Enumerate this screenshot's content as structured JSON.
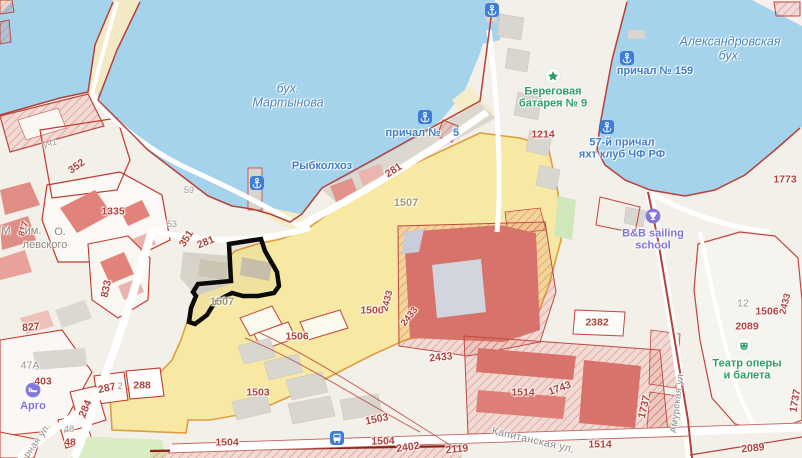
{
  "map": {
    "colors": {
      "water": "#a6d3ec",
      "highlight_parcel": "#f7e9a4",
      "selected_outline": "#0a0a0a",
      "boundary_red": "#b5413a",
      "poi_blue": "#3f7ec6",
      "poi_green": "#2f9e63",
      "poi_purple": "#7f72d8"
    },
    "bay_labels": [
      {
        "name": "martynova-bay-label",
        "lines": [
          "бух.",
          "Мартынова"
        ],
        "x": 288,
        "y": 96
      },
      {
        "name": "alexandrovskaya-bay-label",
        "lines": [
          "Александровская",
          "бух."
        ],
        "x": 730,
        "y": 49
      }
    ],
    "street_labels": [
      {
        "name": "kapitanskaya-street-label",
        "text": "Капитанская ул.",
        "x": 533,
        "y": 441,
        "rotate": 13,
        "size": 10.5
      },
      {
        "name": "amurskaya-street-label",
        "text": "Амурская ул.",
        "x": 678,
        "y": 402,
        "rotate": -83,
        "size": 9.5
      },
      {
        "name": "ernaya-street-label",
        "text": "рная ул.",
        "x": 38,
        "y": 441,
        "rotate": -55,
        "size": 9.5
      }
    ],
    "poi_labels": [
      {
        "name": "prichal-159-label",
        "lines": [
          "причал № 159"
        ],
        "x": 655,
        "y": 71,
        "color": "blue"
      },
      {
        "name": "prichal-label-fragment",
        "lines": [
          "причал №"
        ],
        "x": 413,
        "y": 133,
        "color": "blue"
      },
      {
        "name": "prichal-number-fragment",
        "lines": [
          "5"
        ],
        "x": 456,
        "y": 133,
        "color": "blue"
      },
      {
        "name": "rybkolkhoz-label",
        "lines": [
          "Рыбколхоз"
        ],
        "x": 322,
        "y": 166,
        "color": "blue"
      },
      {
        "name": "beregovaya-batareya-label",
        "lines": [
          "Береговая",
          "батарея № 9"
        ],
        "x": 553,
        "y": 98,
        "color": "green"
      },
      {
        "name": "prichal-57-yacht-club-label",
        "lines": [
          "57-й причал",
          "яхт клуб ЧФ РФ"
        ],
        "x": 622,
        "y": 149,
        "color": "blue"
      },
      {
        "name": "bb-sailing-school-label",
        "lines": [
          "B&B sailing",
          "school"
        ],
        "x": 653,
        "y": 240,
        "color": "purple"
      },
      {
        "name": "opera-ballet-theatre-label",
        "lines": [
          "Театр оперы",
          "и балета"
        ],
        "x": 747,
        "y": 370,
        "color": "green"
      },
      {
        "name": "argo-label",
        "lines": [
          "Арго"
        ],
        "x": 33,
        "y": 406,
        "color": "purple"
      }
    ],
    "icons": [
      {
        "name": "anchor-icon",
        "type": "anchor",
        "x": 492,
        "y": 10
      },
      {
        "name": "anchor-icon",
        "type": "anchor",
        "x": 257,
        "y": 183
      },
      {
        "name": "anchor-icon",
        "type": "anchor",
        "x": 425,
        "y": 117
      },
      {
        "name": "anchor-icon",
        "type": "anchor",
        "x": 627,
        "y": 58
      },
      {
        "name": "anchor-icon",
        "type": "anchor",
        "x": 607,
        "y": 127
      },
      {
        "name": "bus-stop-icon",
        "type": "bus",
        "x": 337,
        "y": 438
      },
      {
        "name": "battery-star-icon",
        "type": "star",
        "x": 553,
        "y": 76
      },
      {
        "name": "sailing-school-trophy-icon",
        "type": "trophy",
        "x": 653,
        "y": 216
      },
      {
        "name": "theatre-mask-icon",
        "type": "theater",
        "x": 744,
        "y": 346
      },
      {
        "name": "argo-hotel-icon",
        "type": "hotel",
        "x": 33,
        "y": 390
      }
    ],
    "cadastral_numbers": [
      {
        "t": "уч1",
        "x": 50,
        "y": 144,
        "c": "grey",
        "r": -15,
        "s": 9
      },
      {
        "t": "352",
        "x": 77,
        "y": 167,
        "c": "red",
        "r": -35
      },
      {
        "t": "1335",
        "x": 113,
        "y": 212,
        "c": "red"
      },
      {
        "t": "817",
        "x": 24,
        "y": 229,
        "c": "red",
        "r": -72,
        "s": 9
      },
      {
        "t": "М",
        "x": 6,
        "y": 232,
        "c": "brown",
        "s": 11
      },
      {
        "t": "им.",
        "x": 33,
        "y": 232,
        "c": "brown",
        "s": 11
      },
      {
        "t": "О.",
        "x": 60,
        "y": 233,
        "c": "brown",
        "s": 11
      },
      {
        "t": "левского",
        "x": 45,
        "y": 246,
        "c": "brown",
        "s": 11
      },
      {
        "t": "59",
        "x": 189,
        "y": 191,
        "c": "grey",
        "s": 9
      },
      {
        "t": "53",
        "x": 172,
        "y": 225,
        "c": "grey",
        "s": 9
      },
      {
        "t": "351",
        "x": 187,
        "y": 239,
        "c": "red",
        "r": -58
      },
      {
        "t": "281",
        "x": 206,
        "y": 243,
        "c": "red",
        "r": -22
      },
      {
        "t": "281",
        "x": 394,
        "y": 171,
        "c": "red",
        "r": -33
      },
      {
        "t": "1507",
        "x": 222,
        "y": 303,
        "c": "olive",
        "s": 11
      },
      {
        "t": "1507",
        "x": 406,
        "y": 204,
        "c": "olive",
        "s": 11
      },
      {
        "t": "833",
        "x": 107,
        "y": 289,
        "c": "red",
        "r": -78
      },
      {
        "t": "827",
        "x": 31,
        "y": 328,
        "c": "red",
        "r": -6
      },
      {
        "t": "47A",
        "x": 30,
        "y": 366,
        "c": "grey"
      },
      {
        "t": "403",
        "x": 43,
        "y": 382,
        "c": "red"
      },
      {
        "t": "287",
        "x": 107,
        "y": 389,
        "c": "red",
        "r": -12
      },
      {
        "t": "2",
        "x": 120,
        "y": 387,
        "c": "grey",
        "s": 9
      },
      {
        "t": "288",
        "x": 142,
        "y": 386,
        "c": "red"
      },
      {
        "t": "284",
        "x": 86,
        "y": 409,
        "c": "red",
        "r": -66
      },
      {
        "t": "48",
        "x": 69,
        "y": 430,
        "c": "grey",
        "s": 9.5
      },
      {
        "t": "48",
        "x": 70,
        "y": 443,
        "c": "red"
      },
      {
        "t": "1506",
        "x": 297,
        "y": 337,
        "c": "red"
      },
      {
        "t": "1506",
        "x": 372,
        "y": 311,
        "c": "red"
      },
      {
        "t": "2433",
        "x": 388,
        "y": 301,
        "c": "red",
        "r": -76,
        "s": 9.5
      },
      {
        "t": "2433",
        "x": 410,
        "y": 317,
        "c": "red",
        "r": -52,
        "s": 9.5
      },
      {
        "t": "2433",
        "x": 441,
        "y": 358,
        "c": "red",
        "r": -6
      },
      {
        "t": "1503",
        "x": 258,
        "y": 393,
        "c": "red"
      },
      {
        "t": "1503",
        "x": 377,
        "y": 420,
        "c": "red",
        "r": -12
      },
      {
        "t": "1504",
        "x": 227,
        "y": 443,
        "c": "red"
      },
      {
        "t": "1504",
        "x": 383,
        "y": 442,
        "c": "red",
        "r": -2
      },
      {
        "t": "1214",
        "x": 543,
        "y": 135,
        "c": "red"
      },
      {
        "t": "1773",
        "x": 785,
        "y": 180,
        "c": "red"
      },
      {
        "t": "2382",
        "x": 597,
        "y": 323,
        "c": "red"
      },
      {
        "t": "1506",
        "x": 767,
        "y": 312,
        "c": "red"
      },
      {
        "t": "2433",
        "x": 786,
        "y": 304,
        "c": "red",
        "r": -76,
        "s": 9.5
      },
      {
        "t": "1514",
        "x": 523,
        "y": 393,
        "c": "red"
      },
      {
        "t": "1743",
        "x": 560,
        "y": 389,
        "c": "red",
        "r": -20
      },
      {
        "t": "1737",
        "x": 645,
        "y": 407,
        "c": "red",
        "r": -77
      },
      {
        "t": "1737",
        "x": 796,
        "y": 401,
        "c": "red",
        "r": -80
      },
      {
        "t": "1514",
        "x": 600,
        "y": 445,
        "c": "red"
      },
      {
        "t": "2402",
        "x": 408,
        "y": 448,
        "c": "red",
        "r": -8
      },
      {
        "t": "2119",
        "x": 457,
        "y": 450,
        "c": "red",
        "r": -6
      },
      {
        "t": "2089",
        "x": 747,
        "y": 327,
        "c": "red"
      },
      {
        "t": "12",
        "x": 743,
        "y": 304,
        "c": "grey"
      },
      {
        "t": "2089",
        "x": 753,
        "y": 449,
        "c": "red",
        "r": -6
      }
    ],
    "selected_parcel": {
      "label": "1507"
    }
  }
}
